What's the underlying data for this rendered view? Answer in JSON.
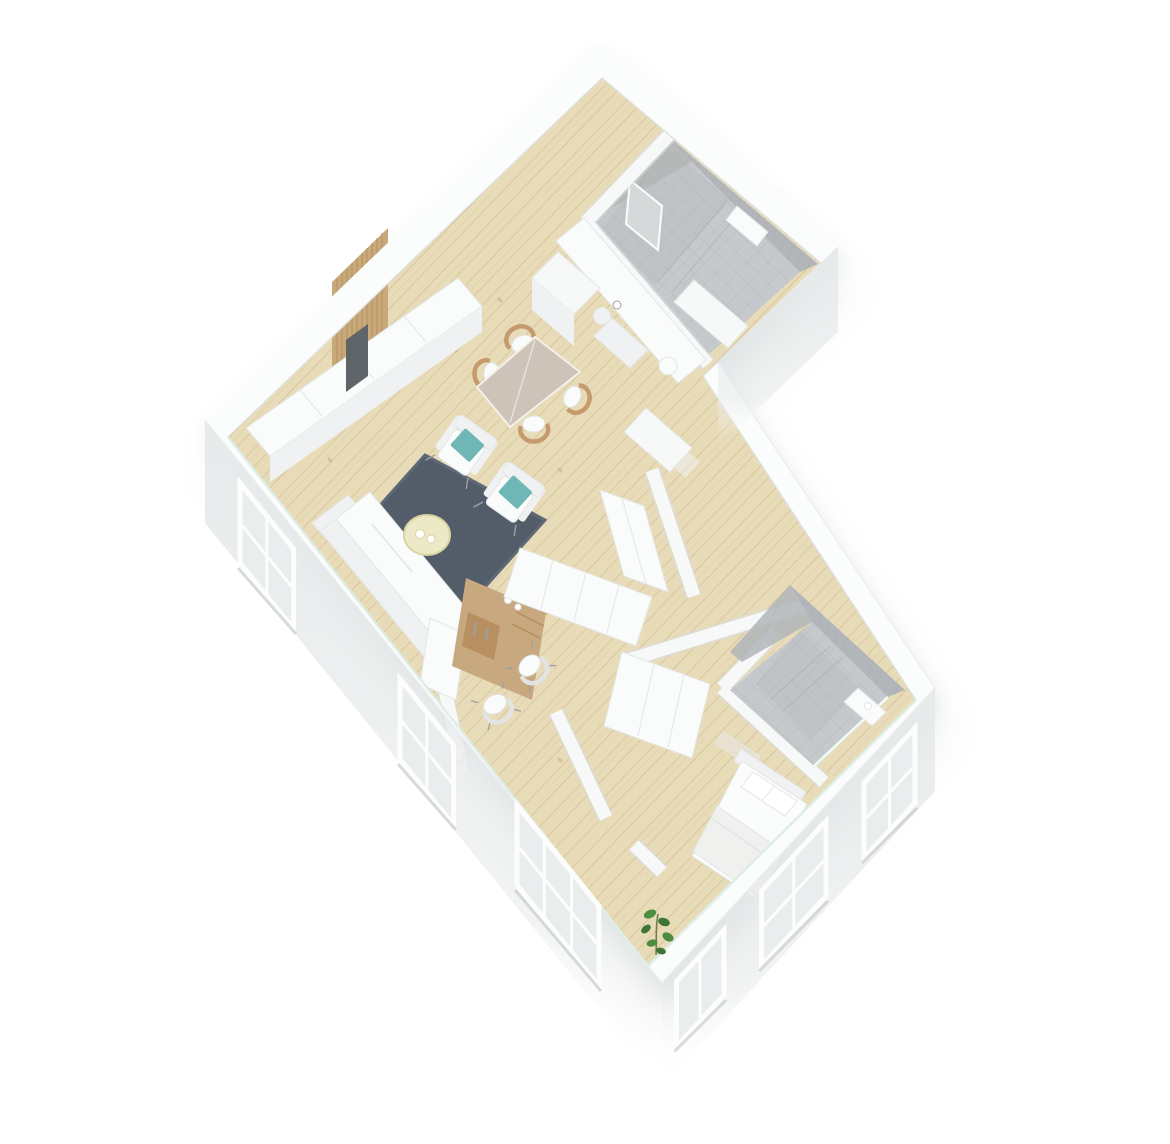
{
  "scene": {
    "title": "3D isometric floor-plan render of a one-bedroom apartment, white walls and light wood floors, viewed from above at a 45-degree rotation",
    "canvas": {
      "width": 1170,
      "height": 1144
    },
    "background": "#ffffff"
  },
  "colors": {
    "bg": "#ffffff",
    "shadow": "#c3c7c9",
    "wallTop": "#fbfcfc",
    "wallEdgeOuter": "#ecefef",
    "wallEdgeInner": "#dde1e2",
    "wallFaceTop": "#e7eaeb",
    "wallFaceBottom": "#ffffff",
    "interiorWall": "#f7f8f8",
    "interiorWallShade": "#d9dcdd",
    "wood": "#e8dbb8",
    "woodStreak": "#d9c69e",
    "woodStreakDark": "#ccb68c",
    "woodKnot": "#c2a87c",
    "tileFloor": "#c6c9cc",
    "tileGrout": "#b6babd",
    "tileWall": "#b2b6ba",
    "tileWallGrout": "#a5a9ad",
    "showerPanel": "#d6d9da",
    "rug": "#535c69",
    "rugEdge": "#5f6875",
    "teal": "#6fb7b7",
    "cream": "#ece9c6",
    "creamEdge": "#d8d4a4",
    "chairWood": "#c59b6e",
    "deskWood": "#c8a87e",
    "drawerWood": "#b78f60",
    "slatWood": "#c9a87a",
    "slatGap": "#b08d5e",
    "tv": "#5f6468",
    "furnitureWhite": "#fafbfb",
    "furnitureShade": "#eff1f2",
    "furnitureEdge": "#e4e7e7",
    "tableCloth": "#cdc3b8",
    "mattress": "#fbfcfc",
    "blanket": "#f0f1ee",
    "pillowEdge": "#e3e5e4",
    "glassWindow": "#e9edee",
    "windowFrame": "#fdfdfd",
    "windowSill": "#c8ccce",
    "glassTeal": "#ddeee6",
    "metal": "#9aa0a4",
    "leaf": "#4e8c42",
    "leafDark": "#3d7534",
    "stem": "#6f7f52"
  },
  "rooms": [
    {
      "name": "living-dining-kitchen",
      "floor": "light wood planks",
      "furniture": [
        "kitchen counter with sink and faucet",
        "tall kitchen cabinet",
        "dining table",
        "4 wooden dining chairs with white cushions",
        "2 white armchairs with teal cushions",
        "round cream coffee table with 2 cups",
        "dark slate rug",
        "white sofa",
        "long white sideboard cabinets",
        "wood slat wall panel",
        "tv"
      ]
    },
    {
      "name": "main-bathroom",
      "floor": "grey tile",
      "furniture": [
        "walk-in shower",
        "shower panel",
        "toilet block",
        "service shaft"
      ]
    },
    {
      "name": "home-office",
      "floor": "light wood planks",
      "furniture": [
        "built-in wood desk with shelves",
        "2 white chairs",
        "white bookcase",
        "closet row"
      ]
    },
    {
      "name": "hallway",
      "floor": "light wood planks",
      "furniture": [
        "closet row",
        "shaft box"
      ]
    },
    {
      "name": "bedroom",
      "floor": "light wood planks",
      "furniture": [
        "double bed with 2 pillows and folded blanket",
        "headboard bench",
        "white wardrobe",
        "potted plant"
      ]
    },
    {
      "name": "ensuite-bathroom",
      "floor": "grey tile",
      "furniture": [
        "walk-in shower with glass wall",
        "corner shelf"
      ]
    }
  ],
  "windows": {
    "southwest_wall": 3,
    "southeast_wall": 3
  }
}
